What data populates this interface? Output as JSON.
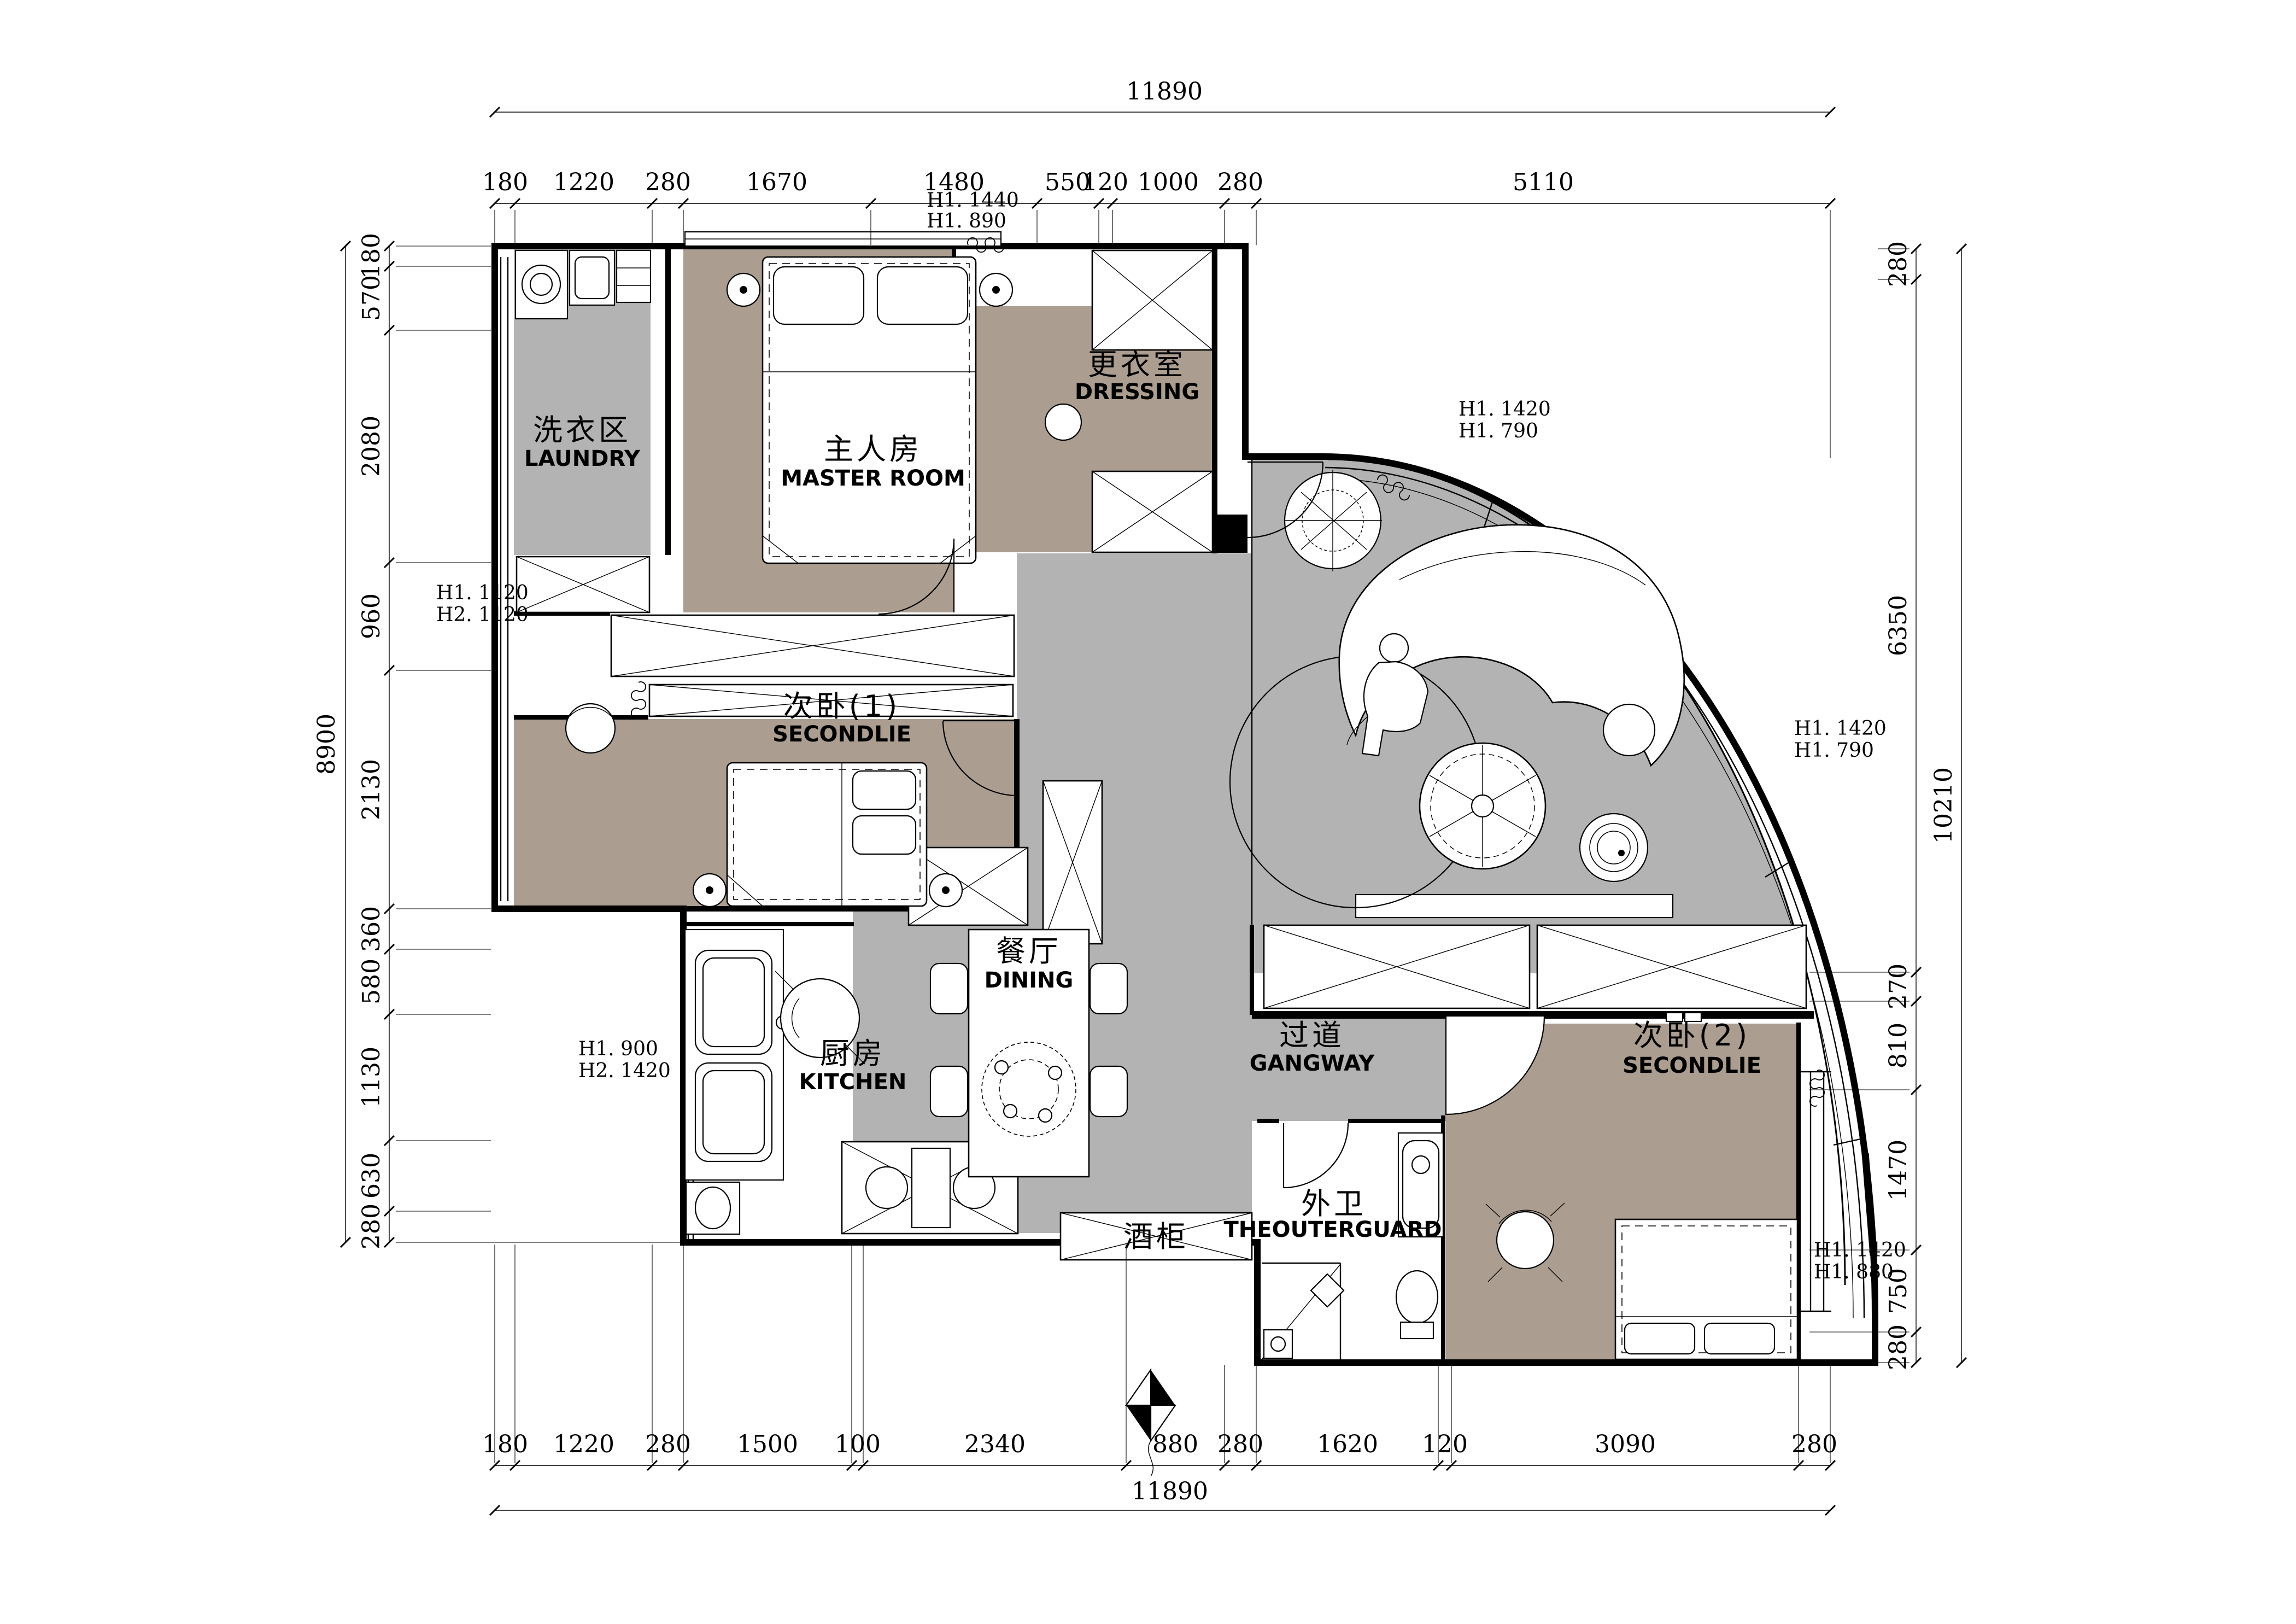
{
  "dimensions": {
    "top": {
      "total": "11890",
      "segments": [
        "180",
        "1220",
        "280",
        "1670",
        "1480",
        "550",
        "120",
        "1000",
        "280",
        "5110"
      ]
    },
    "bottom": {
      "total": "11890",
      "segments": [
        "180",
        "1220",
        "280",
        "1500",
        "100",
        "2340",
        "880",
        "280",
        "1620",
        "120",
        "3090",
        "280"
      ]
    },
    "left": {
      "total": "8900",
      "segments": [
        "180",
        "570",
        "2080",
        "960",
        "2130",
        "360",
        "580",
        "1130",
        "630",
        "280"
      ]
    },
    "right": {
      "total": "10210",
      "segments": [
        "280",
        "6350",
        "270",
        "810",
        "1470",
        "750",
        "280"
      ]
    }
  },
  "rooms": {
    "laundry": {
      "cn": "洗衣区",
      "en": "LAUNDRY"
    },
    "master": {
      "cn": "主人房",
      "en": "MASTER ROOM"
    },
    "dressing": {
      "cn": "更衣室",
      "en": "DRESSING"
    },
    "second1": {
      "cn": "次卧(1)",
      "en": "SECONDLIE"
    },
    "dining": {
      "cn": "餐厅",
      "en": "DINING"
    },
    "kitchen": {
      "cn": "厨房",
      "en": "KITCHEN"
    },
    "gangway": {
      "cn": "过道",
      "en": "GANGWAY"
    },
    "wine_cabinet": {
      "cn": "酒柜"
    },
    "outer_guard": {
      "cn": "外卫",
      "en": "THEOUTERGUARD"
    },
    "second2": {
      "cn": "次卧(2)",
      "en": "SECONDLIE"
    }
  },
  "height_notes": {
    "master_top": [
      "H1. 1440",
      "H1. 890"
    ],
    "living_top": [
      "H1. 1420",
      "H1. 790"
    ],
    "left_mid": [
      "H1. 1120",
      "H2. 1120"
    ],
    "living_right": [
      "H1. 1420",
      "H1. 790"
    ],
    "kitchen_left": [
      "H1. 900",
      "H2. 1420"
    ],
    "second2_right": [
      "H1. 1420",
      "H1. 880"
    ]
  },
  "colors": {
    "bedroom_floor": "#ab9e90",
    "public_floor": "#b3b3b3",
    "wall": "#000000",
    "background": "#ffffff"
  }
}
